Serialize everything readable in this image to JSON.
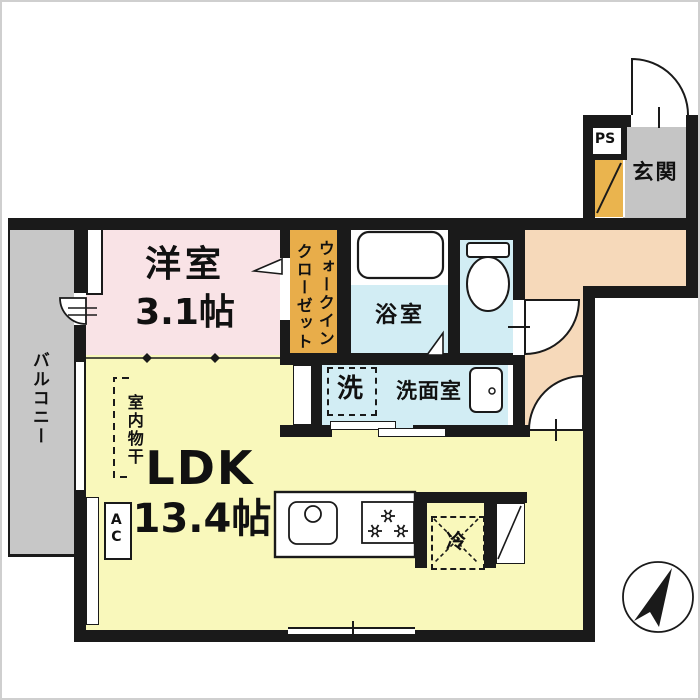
{
  "floorplan": {
    "balcony": {
      "label": "バルコニー"
    },
    "western_room": {
      "name": "洋室",
      "size": "3.1帖"
    },
    "walk_in_closet": {
      "line1": "ウォークイン",
      "line2": "クローゼット"
    },
    "bathroom": {
      "label": "浴室"
    },
    "washroom": {
      "label": "洗面室",
      "washer": "洗"
    },
    "ldk": {
      "name": "LDK",
      "size": "13.4帖",
      "indoor_drying": "室内物干",
      "air_conditioner": "AC"
    },
    "kitchen": {
      "refrigerator": "冷"
    },
    "entrance": {
      "label": "玄関",
      "pipe_space": "PS"
    },
    "colors": {
      "wall": "#1a1a1a",
      "western_room": "#f9e3e6",
      "closet": "#e8ad4a",
      "shoe_cabinet": "#eab44e",
      "ldk": "#f9f8bb",
      "wet_area": "#d2edf4",
      "hallway": "#f6d9ba",
      "balcony": "#c7c7c7",
      "entrance_floor": "#c5c5c5"
    }
  }
}
